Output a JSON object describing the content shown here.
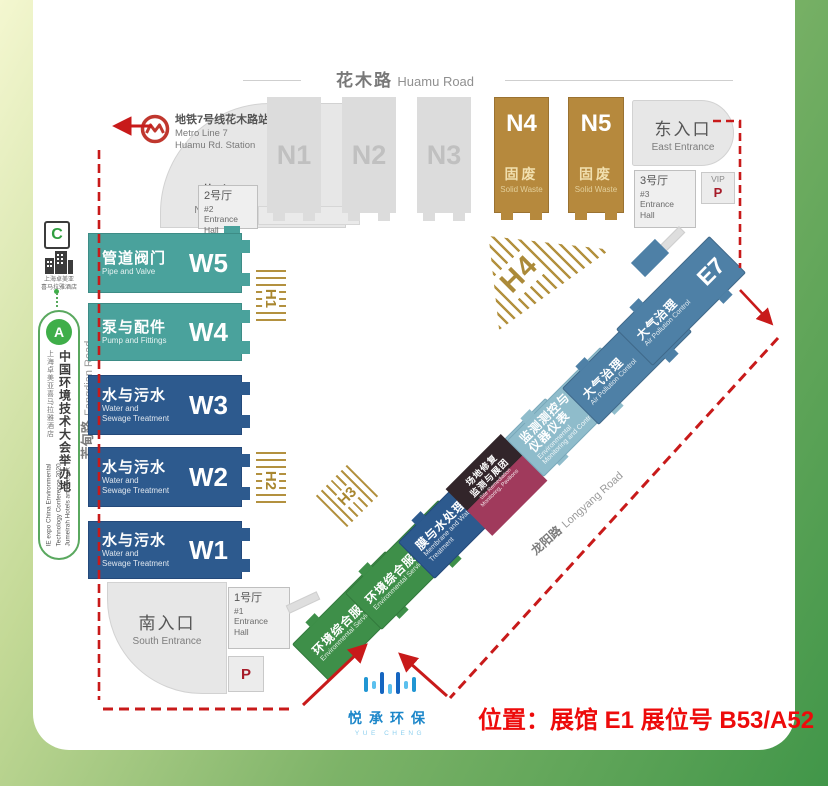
{
  "roads": {
    "huamu_zh": "花木路",
    "huamu_en": "Huamu Road",
    "fangdian_zh": "芳甸路",
    "fangdian_en": "Fangdian Road",
    "longyang_zh": "龙阳路",
    "longyang_en": "Longyang Road"
  },
  "metro": {
    "title_zh": "地铁7号线花木路站",
    "line_en": "Metro Line 7",
    "station_en": "Huamu Rd. Station"
  },
  "entrances": {
    "north_zh": "北入口",
    "north_en": "North Entrance",
    "east_zh": "东入口",
    "east_en": "East Entrance",
    "south_zh": "南入口",
    "south_en": "South Entrance"
  },
  "entrance_halls": {
    "eh1_zh": "1号厅",
    "eh1_no": "#1",
    "eh1_en": "Entrance Hall",
    "eh2_zh": "2号厅",
    "eh2_no": "#2",
    "eh2_en": "Entrance Hall",
    "eh3_zh": "3号厅",
    "eh3_no": "#3",
    "eh3_en": "Entrance Hall"
  },
  "parking": {
    "p": "P",
    "vip_label": "VIP",
    "vip_p": "P"
  },
  "halls": {
    "n": [
      {
        "code": "N1"
      },
      {
        "code": "N2"
      },
      {
        "code": "N3"
      },
      {
        "code": "N4",
        "zh": "固废",
        "en": "Solid Waste"
      },
      {
        "code": "N5",
        "zh": "固废",
        "en": "Solid Waste"
      }
    ],
    "w": [
      {
        "code": "W5",
        "zh": "管道阀门",
        "en1": "Pipe and Valve"
      },
      {
        "code": "W4",
        "zh": "泵与配件",
        "en1": "Pump and Fittings"
      },
      {
        "code": "W3",
        "zh": "水与污水",
        "en1": "Water and",
        "en2": "Sewage Treatment"
      },
      {
        "code": "W2",
        "zh": "水与污水",
        "en1": "Water and",
        "en2": "Sewage Treatment"
      },
      {
        "code": "W1",
        "zh": "水与污水",
        "en1": "Water and",
        "en2": "Sewage Treatment"
      }
    ],
    "e": [
      {
        "code": "E1",
        "zh1": "环境综合服务",
        "en1": "Environmental Services"
      },
      {
        "code": "E2",
        "zh1": "环境综合服务",
        "en1": "Environmental Services"
      },
      {
        "code": "E3",
        "zh1": "膜与水处理",
        "en1": "Membrane and Water",
        "en2": "Treatment"
      },
      {
        "code": "E4"
      },
      {
        "code": "E5",
        "zh1": "监测测控与",
        "zh2": "仪器仪表",
        "en1": "Environmental",
        "en2": "Monitoring and Control"
      },
      {
        "code": "E6",
        "zh1": "大气治理",
        "en1": "Air Pollution Control"
      },
      {
        "code": "E7",
        "zh1": "大气治理",
        "en1": "Air Pollution Control"
      }
    ]
  },
  "hmarks": {
    "h1": "H1",
    "h2": "H2",
    "h3": "H3",
    "h4": "H4"
  },
  "e4_overlay": {
    "zh1": "场地修复",
    "zh2": "监测与展团",
    "en1": "Site Remediation",
    "en2": "Monitoring, Pavilions"
  },
  "sidebar": {
    "c_label": "C",
    "hotel_line1": "上海卓美亚",
    "hotel_line2": "喜马拉雅酒店",
    "expo_letter": "A",
    "badge_main": "中国环境技术大会举办地",
    "badge_sub": "上海卓美亚喜马拉雅酒店",
    "badge_en1": "IE expo China Environmental",
    "badge_en2": "Technology Conference 2020",
    "badge_en3": "Jumeirah Hotels and Resort"
  },
  "footer": {
    "logo_zh": "悦承环保",
    "logo_en": "YUE CHENG",
    "location": "位置：展馆 E1  展位号 B53/A52"
  },
  "colors": {
    "water_blue": "#2d5a8e",
    "pipe_teal": "#4aa29c",
    "solid_waste_gold": "#b6893d",
    "env_green": "#3e8f49",
    "monitoring_light_blue": "#8fbccb",
    "air_steel_blue": "#4e80a6",
    "overlay_dark": "#32252a",
    "overlay_crimson": "#a03a5c",
    "hatch_gold": "#b3913f",
    "annotation_red": "#c81a1a",
    "note_red": "#ed0b0b",
    "logo_blue": "#1b86c9",
    "frame_green": "#419649"
  }
}
